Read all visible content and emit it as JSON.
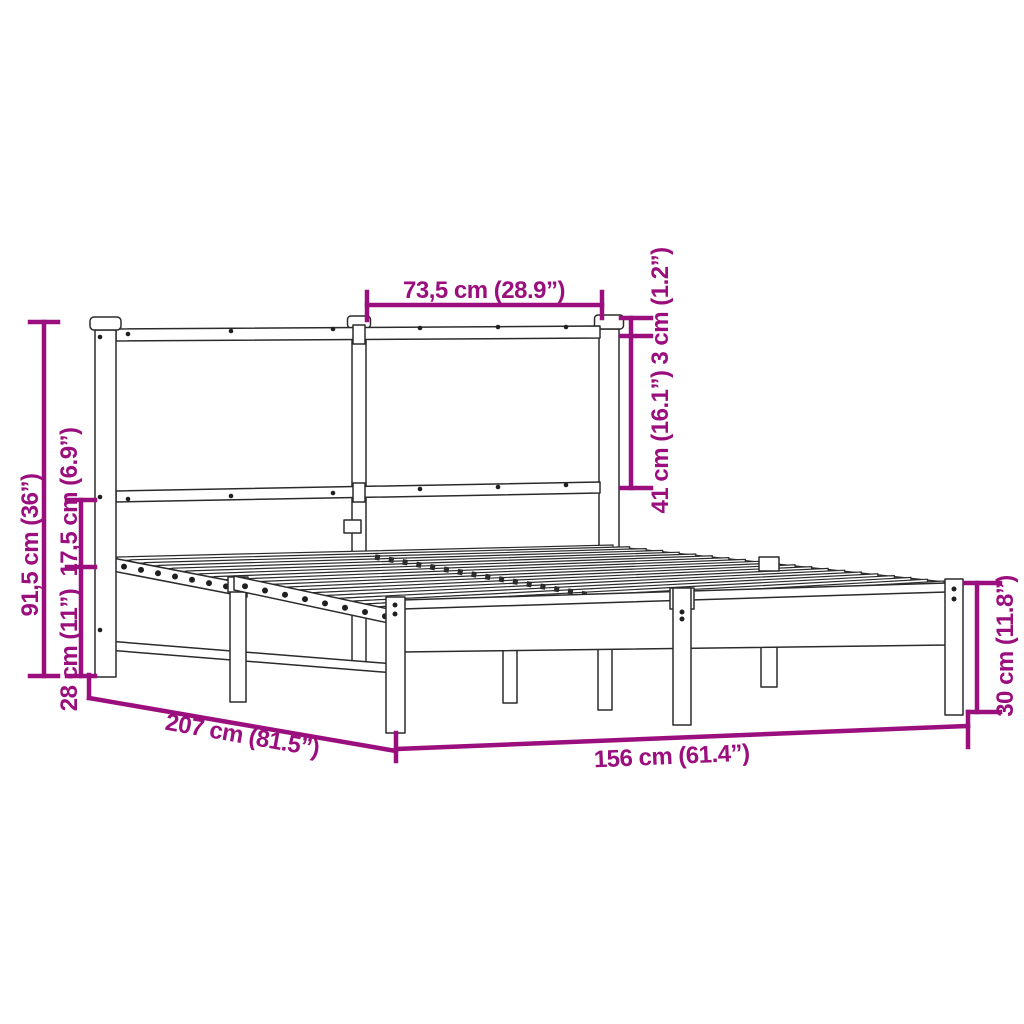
{
  "title": "Metal bed frame with headboard — dimension diagram",
  "style": {
    "background": "#ffffff",
    "line_color": "#2b2b2b",
    "dimension_color": "#9a0e7d"
  },
  "dimensions": {
    "headboard_panel_width": "73,5 cm (28.9”)",
    "top_rail_thickness": "3 cm (1.2”)",
    "headboard_panel_height": "41 cm (16.1”)",
    "headboard_total_height": "91,5 cm (36”)",
    "rail_clearance": "17,5 cm (6.9”)",
    "base_height": "28 cm (11”)",
    "bed_length": "207 cm (81.5”)",
    "bed_width": "156 cm (61.4”)",
    "footboard_height": "30 cm (11.8”)"
  }
}
